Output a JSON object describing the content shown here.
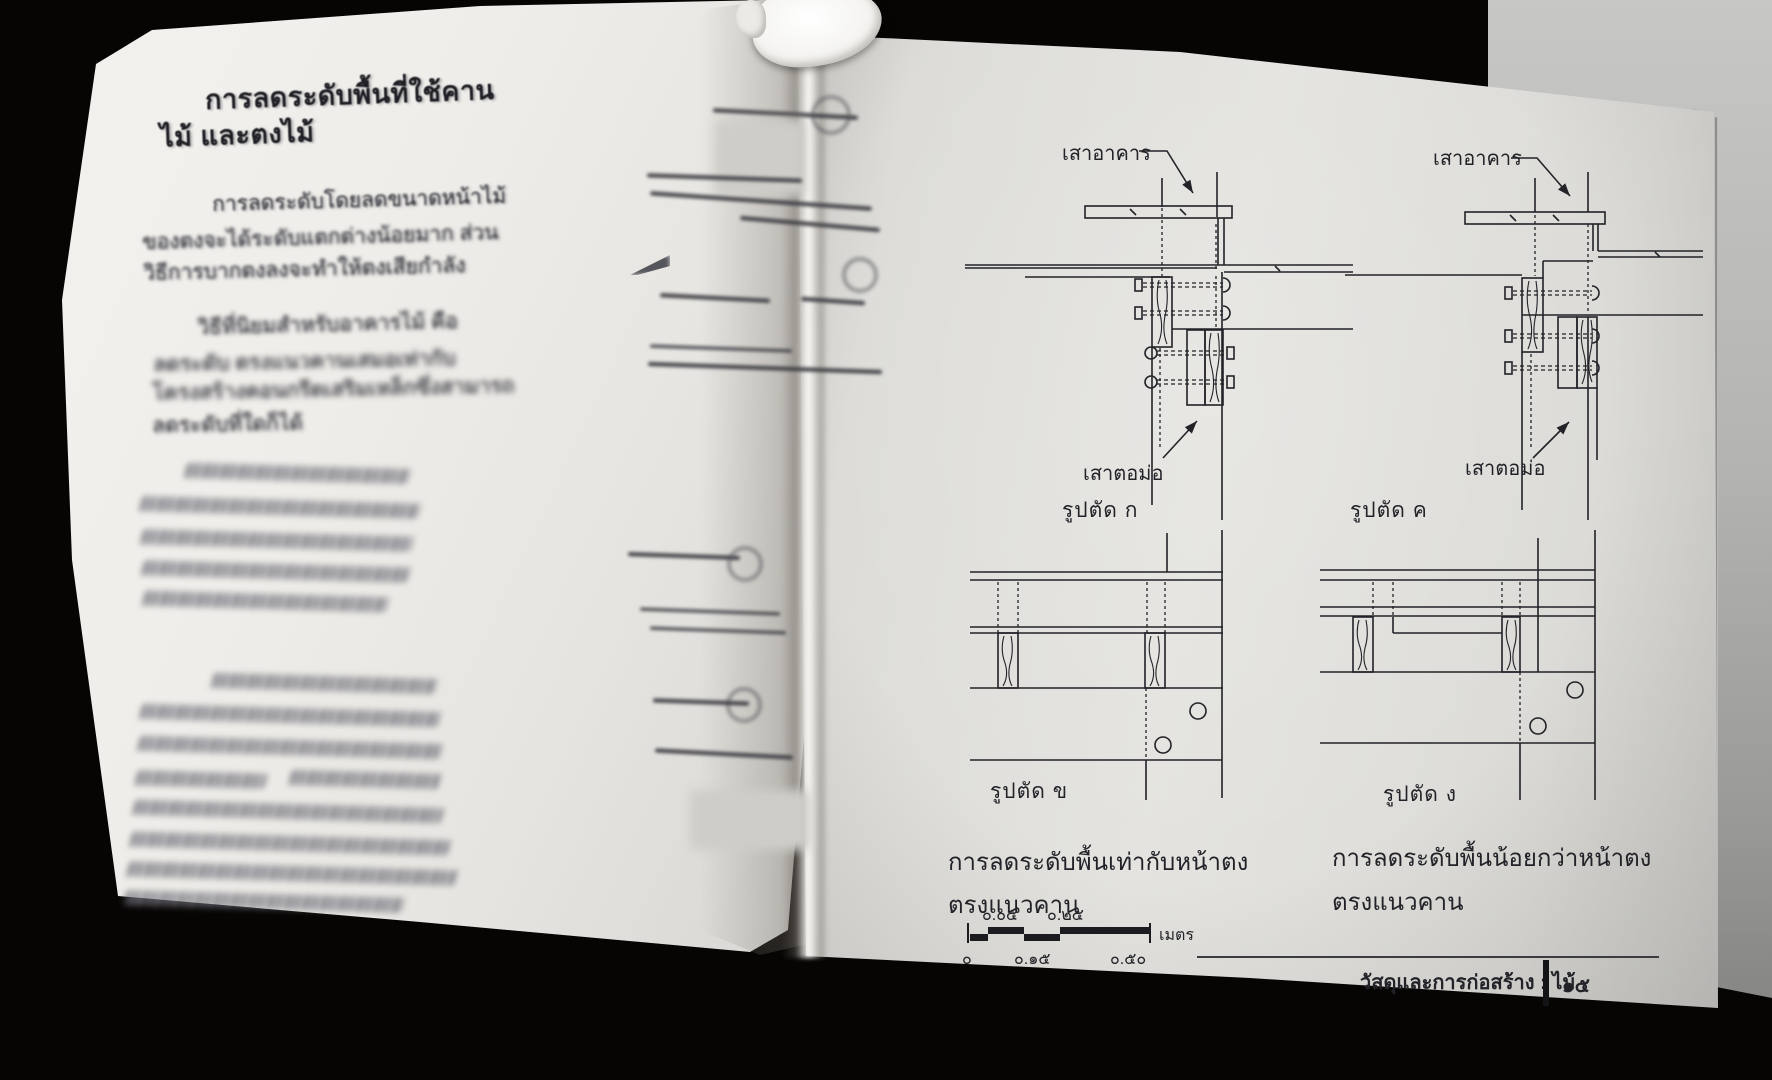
{
  "left_page": {
    "heading": [
      "การลดระดับพื้นที่ใช้คาน",
      "ไม้ และตงไม้"
    ],
    "paragraph1": [
      "การลดระดับโดยลดขนาดหน้าไม้",
      "ของตงจะได้ระดับแตกต่างน้อยมาก ส่วน",
      "วิธีการบากตงลงจะทำให้ตงเสียกำลัง"
    ],
    "paragraph2": [
      "วิธีที่นิยมสำหรับอาคารไม้ คือ",
      "ลดระดับ ตรงแนวคานเสมอเท่ากับ",
      "โครงสร้างคอนกรีตเสริมเหล็กซึ่งสามารถ",
      "ลดระดับที่ใดก็ได้"
    ]
  },
  "right_page": {
    "figures": {
      "k": {
        "column_label": "เสาอาคาร",
        "post_label": "เสาตอม่อ",
        "caption": "รูปตัด ก"
      },
      "kh": {
        "column_label": "เสาอาคาร",
        "post_label": "เสาตอม่อ",
        "caption": "รูปตัด ค"
      },
      "kho": {
        "caption": "รูปตัด ข"
      },
      "ngo": {
        "caption": "รูปตัด ง"
      }
    },
    "caption_left": [
      "การลดระดับพื้นเท่ากับหน้าตง",
      "ตรงแนวคาน"
    ],
    "caption_right": [
      "การลดระดับพื้นน้อยกว่าหน้าตง",
      "ตรงแนวคาน"
    ],
    "scale_bar": {
      "top_labels": [
        "๐.๐๕",
        "๐.๒๕"
      ],
      "bottom_labels": [
        "๐",
        "๐.๑๕",
        "๐.๕๐"
      ],
      "unit": "เมตร"
    },
    "footer": {
      "title": "วัสดุและการก่อสร้าง : ไม้",
      "page_number": "๑๕"
    }
  },
  "colors": {
    "ink": "#222228",
    "page": "#e4e3df",
    "backdrop": "#b4b4b2"
  }
}
